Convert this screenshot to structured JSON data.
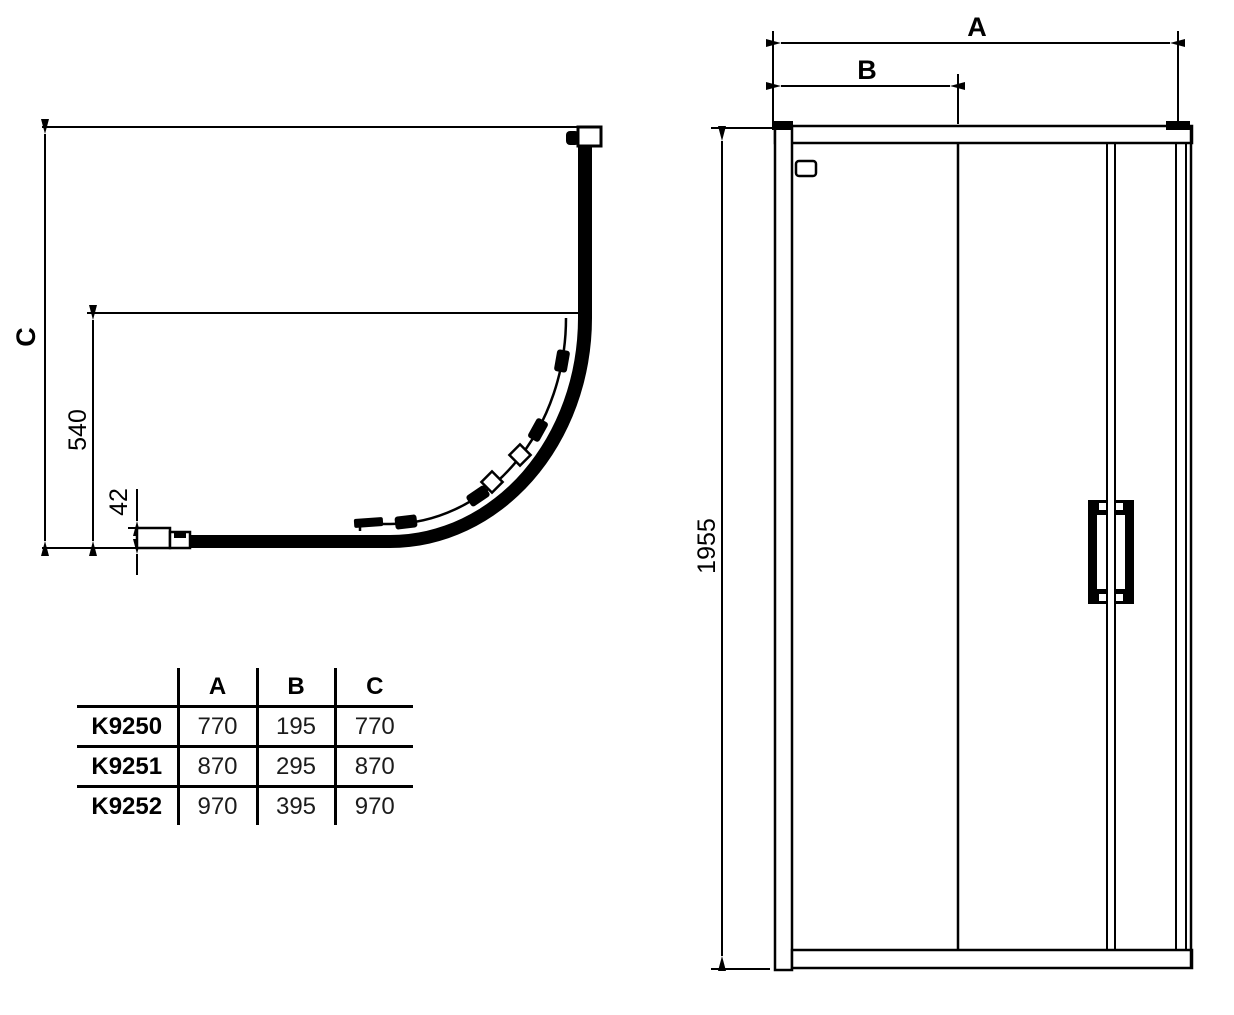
{
  "drawing": {
    "title": "quadrant-shower-enclosure-technical-drawing",
    "line_color": "#000000",
    "background_color": "#ffffff"
  },
  "plan_view": {
    "dim_depth_label": "C",
    "dim_540_label": "540",
    "dim_42_label": "42"
  },
  "elevation_view": {
    "dim_width_label": "A",
    "dim_b_label": "B",
    "dim_height_label": "1955"
  },
  "spec_table": {
    "col_headers": [
      "",
      "A",
      "B",
      "C"
    ],
    "rows": [
      {
        "model": "K9250",
        "a": "770",
        "b": "195",
        "c": "770"
      },
      {
        "model": "K9251",
        "a": "870",
        "b": "295",
        "c": "870"
      },
      {
        "model": "K9252",
        "a": "970",
        "b": "395",
        "c": "970"
      }
    ]
  }
}
